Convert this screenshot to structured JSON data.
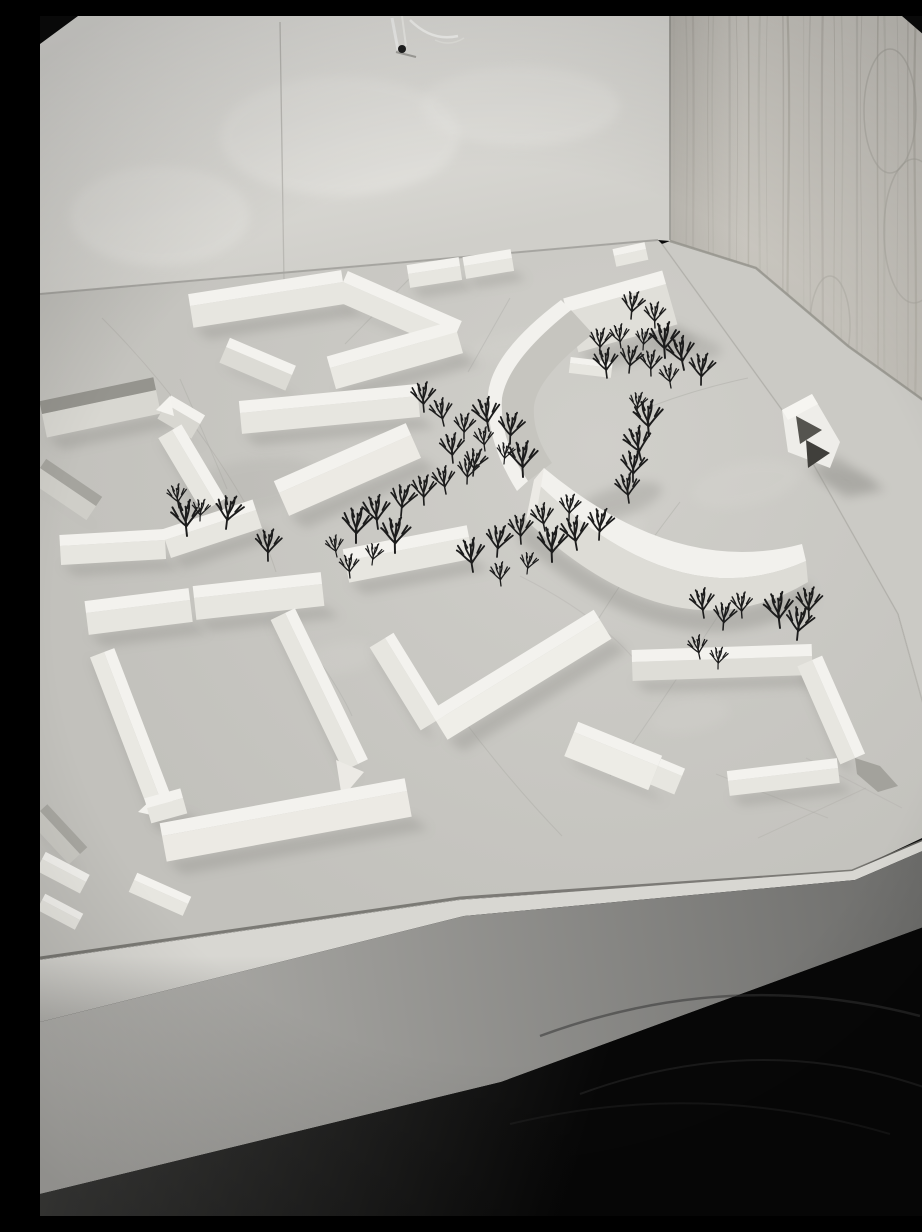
{
  "image": {
    "width": 922,
    "height": 1200,
    "kind": "black-and-white photograph",
    "subject": "white architectural scale model of a housing district with bare model trees, standing on a table in front of a plywood wall and a plaster wall"
  },
  "palette": {
    "film_border": "#0b0b0b",
    "plaster_wall_top": "#eae9e5",
    "plaster_wall_bottom": "#d0cfca",
    "plywood_top": "#d6d3cc",
    "plywood_bottom": "#bcb9b2",
    "plywood_grain": "#b1aea6",
    "board_light": "#d0cfca",
    "board_dark": "#c2c1bc",
    "model_top": "#f3f2ee",
    "model_face": "#e7e6e0",
    "model_shade": "#a3a29c",
    "cast_shadow": "#8c8b86",
    "table_face_light": "#b4b3af",
    "table_face_dark": "#6a6a68",
    "floor": "#070707",
    "tree": "#1c1c1c"
  },
  "scene": {
    "plaster_wall": {
      "poly": [
        [
          0,
          0
        ],
        [
          630,
          0
        ],
        [
          630,
          225
        ],
        [
          618,
          224
        ],
        [
          0,
          278
        ]
      ]
    },
    "plywood_wall": {
      "poly": [
        [
          630,
          0
        ],
        [
          922,
          0
        ],
        [
          922,
          412
        ],
        [
          808,
          330
        ],
        [
          716,
          252
        ],
        [
          630,
          225
        ]
      ],
      "cathedrals": [
        [
          850,
          95,
          26,
          62
        ],
        [
          874,
          215,
          30,
          72
        ],
        [
          790,
          310,
          20,
          50
        ],
        [
          706,
          470,
          16,
          40
        ]
      ]
    },
    "table_wedge": {
      "poly": [
        [
          630,
          225
        ],
        [
          716,
          252
        ],
        [
          808,
          330
        ],
        [
          922,
          412
        ],
        [
          922,
          812
        ],
        [
          916,
          808
        ],
        [
          858,
          598
        ],
        [
          745,
          398
        ],
        [
          622,
          228
        ]
      ]
    },
    "board": {
      "poly": [
        [
          0,
          278
        ],
        [
          618,
          224
        ],
        [
          622,
          228
        ],
        [
          745,
          398
        ],
        [
          858,
          598
        ],
        [
          916,
          806
        ],
        [
          812,
          855
        ],
        [
          420,
          884
        ],
        [
          0,
          944
        ]
      ]
    },
    "bright_strip": {
      "poly": [
        [
          0,
          944
        ],
        [
          420,
          884
        ],
        [
          812,
          855
        ],
        [
          918,
          810
        ],
        [
          922,
          818
        ],
        [
          815,
          864
        ],
        [
          424,
          900
        ],
        [
          0,
          1006
        ]
      ]
    },
    "table_face": {
      "poly": [
        [
          0,
          1006
        ],
        [
          424,
          900
        ],
        [
          815,
          864
        ],
        [
          922,
          818
        ],
        [
          922,
          897
        ],
        [
          461,
          1066
        ],
        [
          0,
          1178
        ]
      ]
    },
    "floor": {
      "poly": [
        [
          0,
          1178
        ],
        [
          461,
          1066
        ],
        [
          922,
          897
        ],
        [
          922,
          1200
        ],
        [
          0,
          1200
        ]
      ]
    },
    "bars": [
      [
        "zigzag-west",
        150,
        290,
        303,
        266,
        12,
        22,
        0,
        0,
        1
      ],
      [
        "zigzag-mid",
        303,
        266,
        417,
        316,
        12,
        20,
        0,
        0,
        1
      ],
      [
        "zigzag-south",
        290,
        352,
        417,
        316,
        12,
        22,
        0,
        "#eae9e3",
        1
      ],
      [
        "north-bar-a",
        368,
        258,
        420,
        250,
        9,
        14,
        0,
        0,
        1
      ],
      [
        "north-bar-b",
        424,
        250,
        472,
        242,
        9,
        13,
        0,
        0,
        1
      ],
      [
        "small-bar-west",
        186,
        331,
        252,
        359,
        10,
        17,
        0,
        "#dcdbd5",
        1
      ],
      [
        "mid-long-bar",
        200,
        397,
        378,
        380,
        12,
        21,
        0,
        0,
        1
      ],
      [
        "dark-roof-slab",
        2,
        398,
        116,
        374,
        13,
        24,
        "#95948e",
        "#d8d7d1",
        1
      ],
      [
        "gable-house-mid",
        126,
        388,
        160,
        408,
        10,
        17,
        0,
        "#d8d7d1",
        1
      ],
      [
        "west-edge-slab",
        0,
        452,
        56,
        490,
        11,
        17,
        "#a5a49e",
        "#cfcec8",
        1
      ],
      [
        "court1-east-slab",
        132,
        414,
        176,
        488,
        11,
        16,
        0,
        0,
        1
      ],
      [
        "court1-south-a",
        20,
        530,
        125,
        524,
        11,
        19,
        0,
        0,
        1
      ],
      [
        "court1-south-b",
        125,
        524,
        216,
        494,
        11,
        19,
        0,
        0,
        1
      ],
      [
        "center-slab-big",
        239,
        477,
        371,
        419,
        13,
        25,
        0,
        "#eceae4",
        1
      ],
      [
        "center-slab-low",
        305,
        545,
        429,
        521,
        12,
        22,
        0,
        0,
        1
      ],
      [
        "v-arm-south",
        345,
        622,
        396,
        705,
        10,
        18,
        0,
        0,
        1
      ],
      [
        "v-arm-long",
        396,
        705,
        560,
        604,
        12,
        22,
        0,
        "#efeee8",
        1
      ],
      [
        "ne-tall-slab",
        527,
        296,
        626,
        268,
        14,
        42,
        0,
        "#e0dfd9",
        1
      ],
      [
        "ne-mini-bar",
        574,
        240,
        606,
        233,
        7,
        11,
        0,
        0,
        0
      ],
      [
        "crescent-link",
        530,
        347,
        572,
        352,
        6,
        10,
        0,
        0,
        0
      ],
      [
        "court2-north-a",
        46,
        597,
        150,
        584,
        12,
        22,
        0,
        0,
        1
      ],
      [
        "court2-north-b",
        154,
        582,
        282,
        568,
        12,
        22,
        0,
        0,
        1
      ],
      [
        "court2-west",
        64,
        636,
        126,
        798,
        11,
        15,
        0,
        "#e9e8e2",
        1
      ],
      [
        "court2-east",
        245,
        597,
        318,
        748,
        11,
        16,
        0,
        "#e6e5df",
        1
      ],
      [
        "court2-south",
        122,
        820,
        367,
        775,
        13,
        26,
        0,
        "#eceae4",
        1
      ],
      [
        "sw-edge-gable",
        0,
        795,
        40,
        838,
        10,
        15,
        "#a8a7a1",
        "#c9c8c2",
        1
      ],
      [
        "sw-house",
        107,
        792,
        143,
        782,
        10,
        16,
        0,
        0,
        1
      ],
      [
        "front-bar-a",
        2,
        843,
        46,
        866,
        8,
        13,
        0,
        0,
        0
      ],
      [
        "front-bar-b",
        2,
        884,
        40,
        904,
        7,
        11,
        0,
        0,
        0
      ],
      [
        "front-bar-c",
        94,
        864,
        148,
        888,
        8,
        13,
        0,
        0,
        0
      ],
      [
        "u-top-bar",
        592,
        646,
        772,
        640,
        12,
        19,
        0,
        "#deddd7",
        1
      ],
      [
        "u-right-bar",
        772,
        644,
        815,
        742,
        11,
        16,
        0,
        0,
        1
      ],
      [
        "u-bottom-bar",
        688,
        765,
        798,
        752,
        10,
        15,
        0,
        0,
        1
      ],
      [
        "l-block",
        534,
        716,
        618,
        750,
        11,
        26,
        0,
        "#edece6",
        1
      ],
      [
        "l-block-cap",
        618,
        750,
        642,
        760,
        8,
        20,
        0,
        0,
        0
      ]
    ],
    "customs": [
      {
        "n": "upper-crescent-face",
        "z": 378,
        "d": "M531,294 Q468,344 462,382 Q459,424 488,465 L512,447 Q492,418 494,390 Q498,360 553,318 Z",
        "f": "#c6c5bf"
      },
      {
        "n": "upper-crescent-band",
        "z": 379,
        "d": "M531,294 Q468,344 462,382 Q459,424 488,465 L477,475 Q446,426 448,378 Q452,336 521,284 Z",
        "f": "#f2f1ed"
      },
      {
        "n": "lower-crescent-shadow",
        "z": 490,
        "d": "M486,504 Q636,645 768,566 L776,586 Q640,668 478,524 Z",
        "f": "#8c8b86",
        "o": 0.38
      },
      {
        "n": "lower-crescent-band",
        "z": 500,
        "d": "M504,452 Q636,562 762,528 L766,545 Q636,603 494,464 Z",
        "f": "#f2f1ed"
      },
      {
        "n": "lower-crescent-face",
        "z": 501,
        "d": "M494,464 Q636,603 766,545 L768,566 Q636,645 486,504 Z",
        "f": "#dddcd6"
      },
      {
        "n": "lower-crescent-cap",
        "z": 502,
        "d": "M504,452 L494,464 L486,504 L498,488 Z",
        "f": "#eceae5"
      },
      {
        "n": "gable-roof-tip",
        "z": 420,
        "d": "M116,394 L130,380 L134,400 Z",
        "f": "#f4f3ef"
      },
      {
        "n": "court2-east-gable",
        "z": 762,
        "d": "M296,744 L324,756 L302,782 Z",
        "f": "#eceae5"
      },
      {
        "n": "sw-house-gable",
        "z": 802,
        "d": "M98,796 L116,779 L120,801 Z",
        "f": "#f2f1ed"
      },
      {
        "n": "chevron-house-shadow",
        "z": 428,
        "d": "M768,452 L796,440 L846,474 L806,482 Z",
        "f": "#8c8b86",
        "o": 0.4
      },
      {
        "n": "chevron-house-body",
        "z": 429,
        "d": "M742,394 L772,378 L800,426 L790,452 L748,436 Z",
        "f": "#eeede9"
      },
      {
        "n": "chevron-house-dark-1",
        "z": 430,
        "d": "M756,400 L782,414 L760,428 Z",
        "f": "#55544f"
      },
      {
        "n": "chevron-house-dark-2",
        "z": 431,
        "d": "M766,424 L790,437 L768,452 Z",
        "f": "#403f3b"
      },
      {
        "n": "chevron-house-ridge",
        "z": 432,
        "d": "M742,394 L772,378 L778,388 L748,404 Z",
        "f": "#f6f5f1"
      },
      {
        "n": "u-right-east-face",
        "z": 765,
        "d": "M815,742 L840,750 L858,770 L838,776 L817,758 Z",
        "f": "#a3a29c"
      }
    ],
    "shadow_ellipses": [
      [
        578,
        486,
        46,
        15,
        -18,
        0.3
      ],
      [
        648,
        330,
        34,
        12,
        10,
        0.28
      ],
      [
        806,
        464,
        30,
        10,
        8,
        0.2
      ],
      [
        210,
        470,
        70,
        26,
        -10,
        0.12
      ]
    ],
    "stains": [
      [
        560,
        520,
        48,
        20,
        -15,
        0.3
      ],
      [
        706,
        468,
        55,
        22,
        -12,
        0.3
      ],
      [
        300,
        642,
        38,
        16,
        -10,
        0.25
      ],
      [
        470,
        330,
        40,
        14,
        -8,
        0.22
      ],
      [
        650,
        700,
        40,
        16,
        -10,
        0.22
      ]
    ],
    "wall_mottles": [
      [
        300,
        120,
        120,
        60,
        0.35
      ],
      [
        120,
        200,
        90,
        50,
        0.3
      ],
      [
        480,
        90,
        100,
        40,
        0.3
      ]
    ],
    "pencil_lines": [
      {
        "d": "M62,302 Q120,360 170,432 T236,556",
        "o": 0.55
      },
      {
        "d": "M140,363 Q165,420 187,473",
        "o": 0.5
      },
      {
        "d": "M380,252 L305,328",
        "o": 0.5
      },
      {
        "d": "M470,282 L428,356",
        "o": 0.45
      },
      {
        "d": "M612,390 Q660,372 708,362",
        "o": 0.5
      },
      {
        "d": "M640,486 Q586,556 538,636",
        "o": 0.5
      },
      {
        "d": "M700,566 Q620,690 570,760",
        "o": 0.45
      },
      {
        "d": "M422,702 Q470,766 522,820",
        "o": 0.5
      },
      {
        "d": "M250,606 Q296,664 312,700",
        "o": 0.45
      },
      {
        "d": "M676,758 L788,802",
        "o": 0.4
      },
      {
        "d": "M718,822 L826,772",
        "o": 0.4
      },
      {
        "d": "M766,742 L862,792",
        "o": 0.35
      },
      {
        "d": "M480,560 Q560,600 600,650",
        "o": 0.35
      }
    ],
    "structure_lines": [
      {
        "n": "plaster-seam",
        "d": "M240,6 L244,266",
        "c": "#b4b3ae",
        "w": 1.3,
        "o": 0.8
      },
      {
        "n": "wall-corner",
        "d": "M630,0 L630,224",
        "c": "#9b9a94",
        "w": 2,
        "o": 0.85
      },
      {
        "n": "plaster-base",
        "d": "M0,278 L618,224",
        "c": "#a3a29d",
        "w": 2,
        "o": 0.9
      },
      {
        "n": "plywood-base",
        "d": "M630,225 L716,252 L808,330 L922,412",
        "c": "#94928b",
        "w": 2.5,
        "o": 0.8
      },
      {
        "n": "board-edge",
        "d": "M622,228 L745,398 L858,598 L916,806",
        "c": "#b0afa9",
        "w": 1.5,
        "o": 0.7
      },
      {
        "n": "board-front-groove",
        "d": "M0,942 L420,882 L812,855 L918,810",
        "c": "#6e6d69",
        "w": 3,
        "o": 0.85
      }
    ],
    "floor_arcs": [
      {
        "d": "M500,1020 Q690,950 880,1000",
        "c": "#343434",
        "w": 2.5,
        "o": 0.55
      },
      {
        "d": "M540,1078 Q720,1012 892,1074",
        "c": "#2e2e2e",
        "w": 2,
        "o": 0.5
      },
      {
        "d": "M470,1108 Q660,1062 850,1118",
        "c": "#2a2a2a",
        "w": 2,
        "o": 0.4
      }
    ],
    "film": {
      "top_left_corner": "M0,0 L38,0 L0,28 Z",
      "top_right_corner": "M862,0 L922,0 L922,52 Z",
      "right_strip_a": "M912,0 L922,0 L922,200 L914,200 Z",
      "right_strip_b": "M914,200 L922,200 L922,392 L916,392 Z"
    },
    "tape_mark": {
      "lines": [
        {
          "d": "M352,2 L358,34",
          "c": "#f7f7f4",
          "w": 3,
          "o": 0.95
        },
        {
          "d": "M362,0 L366,30",
          "c": "#f4f4f0",
          "w": 2,
          "o": 0.9
        },
        {
          "d": "M370,4 Q392,26 418,20",
          "c": "#fafaf7",
          "w": 2.5,
          "o": 0.95
        },
        {
          "d": "M395,24 Q410,31 424,22",
          "c": "#eeede9",
          "w": 1.5,
          "o": 0.8
        },
        {
          "d": "M356,36 L376,41",
          "c": "#8b8a86",
          "w": 2,
          "o": 0.7
        }
      ],
      "dot": [
        362,
        33,
        4
      ]
    },
    "trees": [
      [
        297,
        541
      ],
      [
        316,
        527
      ],
      [
        338,
        513
      ],
      [
        361,
        500
      ],
      [
        384,
        489
      ],
      [
        406,
        478
      ],
      [
        427,
        468
      ],
      [
        310,
        562
      ],
      [
        332,
        549
      ],
      [
        355,
        537
      ],
      [
        433,
        556
      ],
      [
        457,
        541
      ],
      [
        481,
        528
      ],
      [
        505,
        515
      ],
      [
        529,
        504
      ],
      [
        461,
        570
      ],
      [
        487,
        558
      ],
      [
        512,
        546
      ],
      [
        537,
        534
      ],
      [
        559,
        524
      ],
      [
        384,
        396
      ],
      [
        404,
        410
      ],
      [
        424,
        423
      ],
      [
        445,
        435
      ],
      [
        464,
        448
      ],
      [
        483,
        461
      ],
      [
        449,
        415
      ],
      [
        470,
        428
      ],
      [
        413,
        447
      ],
      [
        433,
        460
      ],
      [
        560,
        338
      ],
      [
        581,
        332
      ],
      [
        603,
        334
      ],
      [
        625,
        342
      ],
      [
        644,
        354
      ],
      [
        661,
        369
      ],
      [
        567,
        362
      ],
      [
        589,
        357
      ],
      [
        611,
        360
      ],
      [
        631,
        372
      ],
      [
        597,
        398
      ],
      [
        609,
        420
      ],
      [
        601,
        444
      ],
      [
        593,
        466
      ],
      [
        589,
        487
      ],
      [
        591,
        303
      ],
      [
        615,
        312
      ],
      [
        139,
        492
      ],
      [
        160,
        505
      ],
      [
        147,
        520
      ],
      [
        186,
        513
      ],
      [
        228,
        545
      ],
      [
        664,
        602
      ],
      [
        683,
        614
      ],
      [
        702,
        602
      ],
      [
        660,
        643
      ],
      [
        678,
        653
      ],
      [
        740,
        612
      ],
      [
        757,
        624
      ],
      [
        769,
        603
      ]
    ]
  }
}
